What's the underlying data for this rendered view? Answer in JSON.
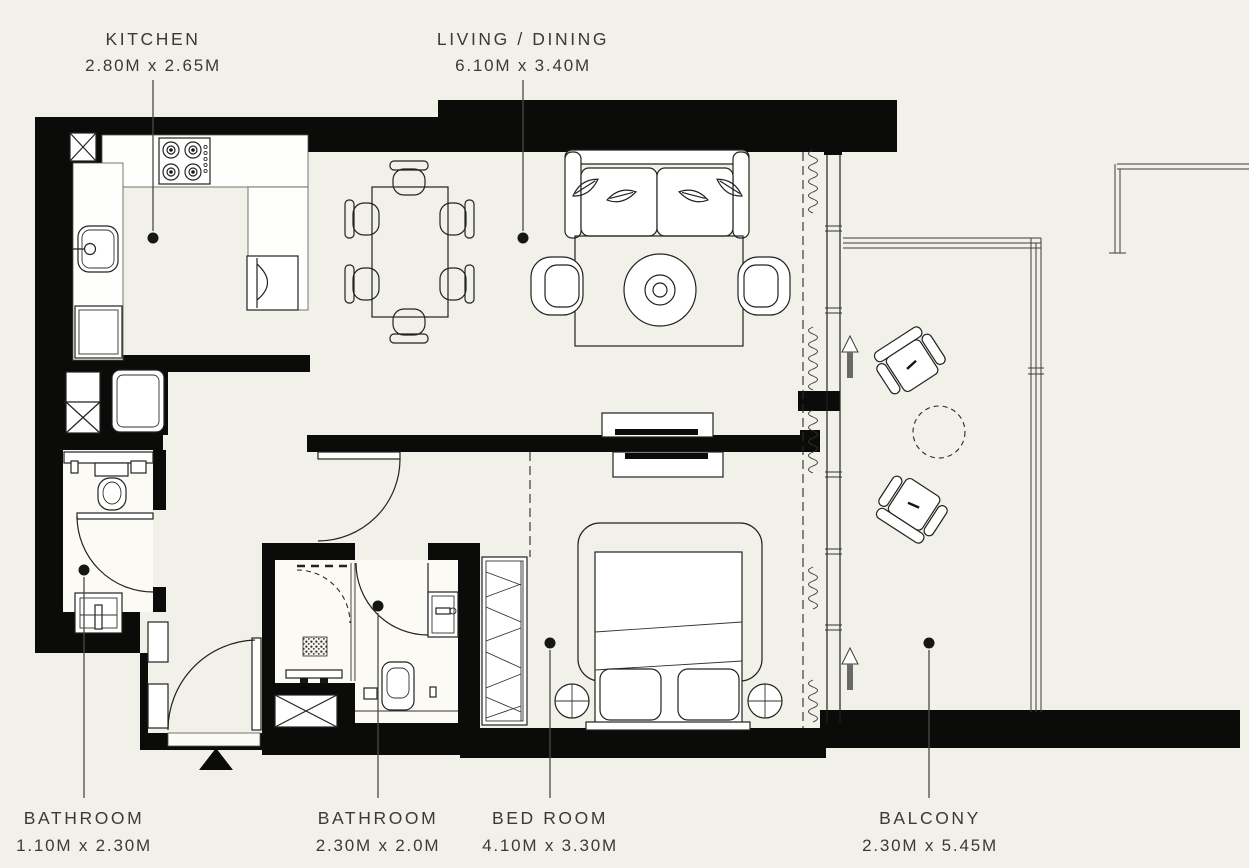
{
  "colors": {
    "background": "#f2f1e9",
    "walls": "#0b0b09",
    "lines": "#22221f",
    "text": "#3b3a35",
    "floor_white": "#fbfaf5"
  },
  "labels": [
    {
      "id": "kitchen",
      "name": "KITCHEN",
      "dims": "2.80M x 2.65M",
      "position": "top"
    },
    {
      "id": "living-dining",
      "name": "LIVING / DINING",
      "dims": "6.10M x 3.40M",
      "position": "top"
    },
    {
      "id": "bathroom-1",
      "name": "BATHROOM",
      "dims": "1.10M x 2.30M",
      "position": "bottom"
    },
    {
      "id": "bathroom-2",
      "name": "BATHROOM",
      "dims": "2.30M x 2.0M",
      "position": "bottom"
    },
    {
      "id": "bedroom",
      "name": "BED ROOM",
      "dims": "4.10M x 3.30M",
      "position": "bottom"
    },
    {
      "id": "balcony",
      "name": "BALCONY",
      "dims": "2.30M x 5.45M",
      "position": "bottom"
    }
  ],
  "furniture": [
    "four-burner-stove",
    "kitchen-sink",
    "refrigerator",
    "built-in-oven",
    "service-shaft",
    "washing-machine",
    "dining-table",
    "dining-chairs",
    "sofa",
    "decor-leaves",
    "area-rug",
    "round-coffee-table",
    "armchairs",
    "tv-console",
    "double-bed",
    "pillows",
    "nightstands",
    "wardrobe",
    "walk-in-shower",
    "shower-drain",
    "toilets",
    "wash-basins",
    "entry-door",
    "interior-doors",
    "curtains",
    "sliding-windows",
    "balcony-railing",
    "balcony-chairs",
    "balcony-round-table",
    "entrance-marker",
    "direction-arrows"
  ]
}
